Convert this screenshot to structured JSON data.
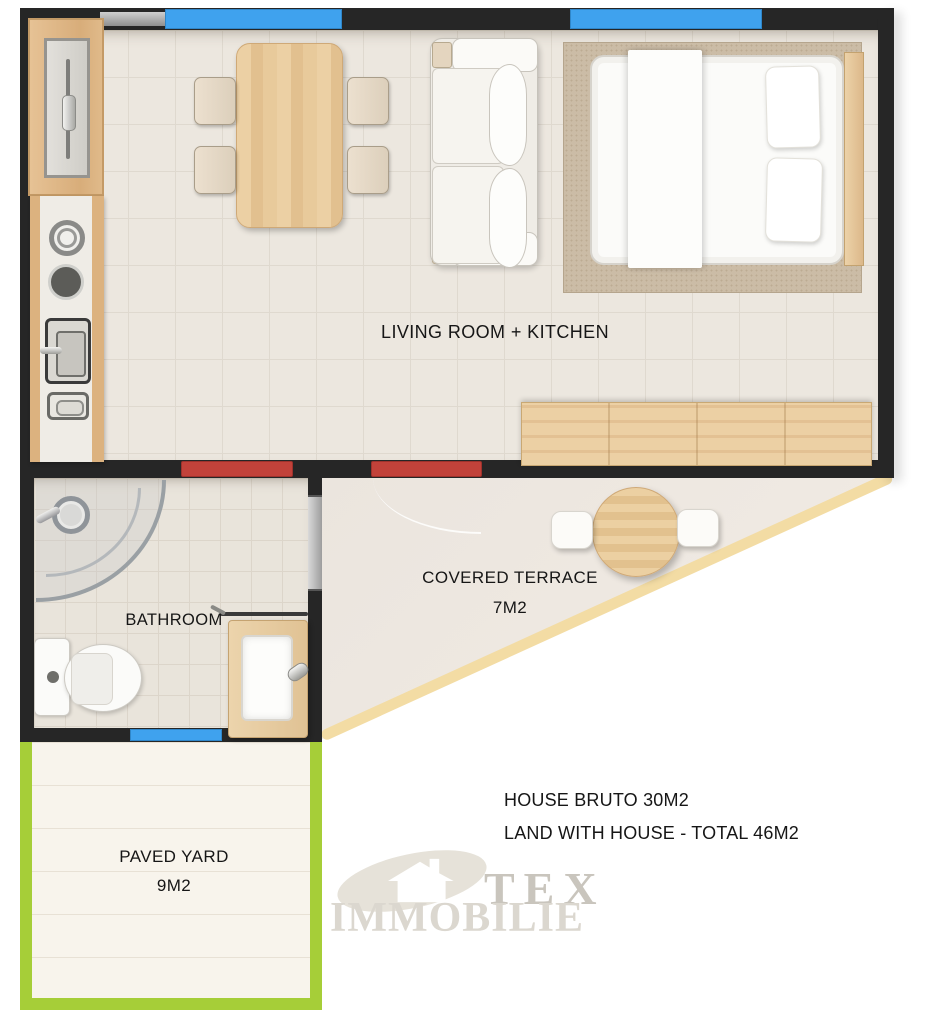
{
  "labels": {
    "living": "LIVING ROOM + KITCHEN",
    "bathroom": "BATHROOM",
    "terrace_line1": "COVERED TERRACE",
    "terrace_line2": "7M2",
    "yard_line1": "PAVED YARD",
    "yard_line2": "9M2"
  },
  "notes": {
    "line1": "HOUSE BRUTO 30M2",
    "line2": "LAND WITH HOUSE - TOTAL 46M2"
  },
  "watermark": {
    "brand_top": "TEX",
    "brand_bottom": "IMMOBILIE"
  },
  "legend_colors": {
    "wall": "#262626",
    "window": "#3fa2ee",
    "door": "#c2423a",
    "yard_border": "#a6ce38",
    "terrace_edge": "#f3dca4"
  },
  "furniture": [
    "fridge",
    "kitchen-counter-with-hob-and-sink",
    "dining-table",
    "chairs-x4",
    "sofa",
    "double-bed",
    "rug",
    "sideboard",
    "corner-shower",
    "toilet",
    "washbasin-vanity",
    "round-terrace-table",
    "stools-x2"
  ]
}
